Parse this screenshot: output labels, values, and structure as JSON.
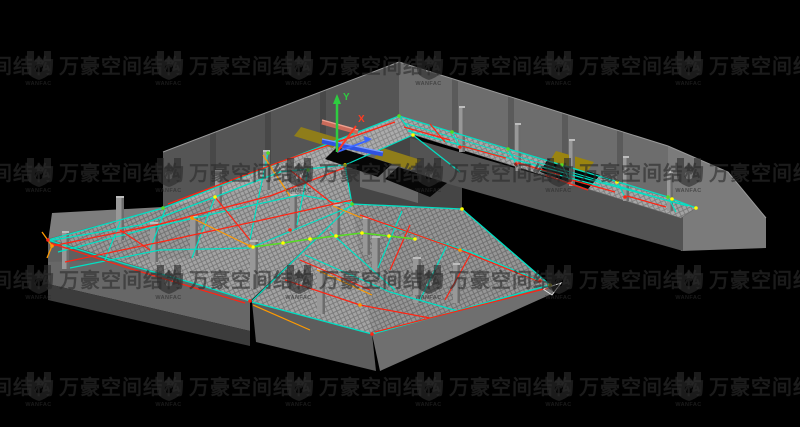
{
  "watermark": {
    "text": "万豪空间结构",
    "logo_text": "WANFAC",
    "color": "rgba(44,44,44,0.62)",
    "grid": {
      "x0": -105,
      "y0": -57,
      "step_x": 130,
      "step_y": 107,
      "cols": 7,
      "rows": 5
    }
  },
  "viewport": {
    "background": "#000000",
    "width": 800,
    "height": 427
  },
  "axis": {
    "y_label": "Y",
    "x_label": "X",
    "y_color": "#2ecc40",
    "x_color": "#ff3b22",
    "z_color": "#3a66ff",
    "origin": [
      337,
      152
    ],
    "y_end": [
      337,
      100
    ],
    "x_end": [
      356,
      126
    ],
    "z_end": [
      369,
      140
    ]
  },
  "palette": {
    "cyan": "#00e0c4",
    "red": "#ff2413",
    "orange": "#ff9a00",
    "green": "#55dd22",
    "yellow": "#ffff00",
    "white": "#e0e0e0",
    "gray": "#9a9a9a",
    "mesh": "#a3a3a3",
    "wall": "#6d6d6d",
    "slab": "#5d5d5d",
    "stair": "#8f7d1a",
    "beam_blue": "#2f52e0",
    "beam_salmon": "#c96a5a"
  },
  "model": {
    "base_polygons": [
      {
        "name": "left-back-wall",
        "points": "163,152 399,62 399,116 163,208",
        "fill": "#555555"
      },
      {
        "name": "wall-pilaster",
        "points": "210,134 216,132 216,184 210,186",
        "fill": "#484848"
      },
      {
        "name": "wall-pilaster",
        "points": "265,113 271,111 271,163 265,165",
        "fill": "#484848"
      },
      {
        "name": "wall-pilaster",
        "points": "320,92 326,90 326,142 320,144",
        "fill": "#484848"
      },
      {
        "name": "right-back-wall",
        "points": "399,62 668,146 668,207 399,116",
        "fill": "#6d6d6d"
      },
      {
        "name": "wall-pilaster",
        "points": "452,79 458,81 458,134 452,132",
        "fill": "#5a5a5a"
      },
      {
        "name": "wall-pilaster",
        "points": "508,96 514,98 514,151 508,149",
        "fill": "#5a5a5a"
      },
      {
        "name": "wall-pilaster",
        "points": "562,113 568,115 568,168 562,166",
        "fill": "#5a5a5a"
      },
      {
        "name": "wall-pilaster",
        "points": "617,130 623,132 623,185 617,183",
        "fill": "#5a5a5a"
      },
      {
        "name": "right-end-cap",
        "points": "668,146 728,172 766,218 766,248 681,251 668,207",
        "fill": "#7b7b7b"
      },
      {
        "name": "bay-floor",
        "points": "345,165 413,135 462,173 462,209 352,204",
        "fill": "#454545"
      },
      {
        "name": "inner-corner-wall",
        "points": "360,147 418,163 418,203 360,187",
        "fill": "#696969"
      },
      {
        "name": "right-front-slab",
        "points": "410,138 683,216 683,251 410,173",
        "fill": "#535353"
      },
      {
        "name": "left-end-cap",
        "points": "52,213 163,207 163,214 48,242",
        "fill": "#7d7d7d"
      },
      {
        "name": "left-front-slab",
        "points": "48,238 250,301 250,331 48,284",
        "fill": "#676767"
      },
      {
        "name": "left-front-slab-lower",
        "points": "48,284 250,331 250,346 48,300",
        "fill": "#3c3c3c"
      },
      {
        "name": "bottom-front-slab",
        "points": "252,302 372,334 376,371 256,342",
        "fill": "#5d5d5d"
      },
      {
        "name": "bottom-se-slab",
        "points": "372,334 550,285 554,293 380,371",
        "fill": "#6f6f6f"
      }
    ],
    "mesh_polygons": [
      {
        "name": "left-wing-mesh",
        "points": "163,208 399,116 413,135 345,165 352,204 250,301 48,239"
      },
      {
        "name": "bottom-wing-mesh",
        "points": "352,204 462,209 550,285 372,334 252,302"
      },
      {
        "name": "right-wing-mesh",
        "points": "399,116 672,199 696,208 681,218 408,133"
      }
    ],
    "mesh_shades": [
      {
        "points": "163,208 399,116 413,135 345,165",
        "fill": "rgba(255,255,255,0.10)"
      },
      {
        "points": "352,204 462,209 550,285 372,334",
        "fill": "rgba(0,0,0,0.08)"
      },
      {
        "points": "399,116 672,199 681,218 408,133",
        "fill": "rgba(255,255,255,0.06)"
      },
      {
        "points": "48,239 163,208 215,197 192,258 48,262",
        "fill": "rgba(0,0,0,0.06)"
      }
    ],
    "overlay_polygons": [
      {
        "name": "floor-opening",
        "points": "337,147 392,164 378,177 325,159",
        "fill": "#060606"
      },
      {
        "name": "floor-opening",
        "points": "398,167 447,183 430,197 385,179",
        "fill": "#060606"
      },
      {
        "name": "floor-opening",
        "points": "548,159 600,175 588,189 540,172",
        "fill": "#060606"
      },
      {
        "name": "stair-panel",
        "points": "301,127 341,139 333,148 294,136",
        "fill": "#8f7d1a"
      },
      {
        "name": "stair-panel",
        "points": "383,148 421,160 411,170 374,158",
        "fill": "#8f7d1a"
      },
      {
        "name": "stair-panel",
        "points": "556,151 594,162 586,173 549,162",
        "fill": "#9a8410"
      }
    ],
    "columns": [
      {
        "x": 62,
        "y": 231,
        "h": 38,
        "w": 7
      },
      {
        "x": 116,
        "y": 196,
        "h": 44,
        "w": 8
      },
      {
        "x": 150,
        "y": 222,
        "h": 40,
        "w": 8
      },
      {
        "x": 190,
        "y": 216,
        "h": 40,
        "w": 8
      },
      {
        "x": 215,
        "y": 170,
        "h": 36,
        "w": 7
      },
      {
        "x": 263,
        "y": 150,
        "h": 40,
        "w": 7
      },
      {
        "x": 290,
        "y": 194,
        "h": 36,
        "w": 7
      },
      {
        "x": 333,
        "y": 204,
        "h": 36,
        "w": 7
      },
      {
        "x": 363,
        "y": 217,
        "h": 38,
        "w": 7
      },
      {
        "x": 250,
        "y": 240,
        "h": 48,
        "w": 8
      },
      {
        "x": 317,
        "y": 268,
        "h": 46,
        "w": 8
      },
      {
        "x": 372,
        "y": 236,
        "h": 42,
        "w": 8
      },
      {
        "x": 413,
        "y": 257,
        "h": 46,
        "w": 8
      },
      {
        "x": 453,
        "y": 263,
        "h": 40,
        "w": 7
      },
      {
        "x": 459,
        "y": 106,
        "h": 46,
        "w": 6
      },
      {
        "x": 515,
        "y": 123,
        "h": 48,
        "w": 6
      },
      {
        "x": 569,
        "y": 139,
        "h": 47,
        "w": 6
      },
      {
        "x": 623,
        "y": 156,
        "h": 45,
        "w": 6
      },
      {
        "x": 667,
        "y": 171,
        "h": 40,
        "w": 6
      }
    ],
    "lines": [
      {
        "c": "gray",
        "w": 1,
        "p": "163,152 399,62"
      },
      {
        "c": "gray",
        "w": 1,
        "p": "399,62 668,146"
      },
      {
        "c": "gray",
        "w": 1,
        "p": "668,146 728,172 766,218"
      },
      {
        "c": "cyan",
        "w": 1.3,
        "p": "399,116 668,197"
      },
      {
        "c": "cyan",
        "w": 1.3,
        "p": "408,131 688,206"
      },
      {
        "c": "cyan",
        "w": 1,
        "p": "404,123 676,203"
      },
      {
        "c": "cyan",
        "w": 1.3,
        "p": "672,199 696,208"
      },
      {
        "c": "cyan",
        "w": 1.2,
        "p": "452,132 460,147"
      },
      {
        "c": "cyan",
        "w": 1.2,
        "p": "508,149 516,164"
      },
      {
        "c": "cyan",
        "w": 1.2,
        "p": "562,165 570,181"
      },
      {
        "c": "cyan",
        "w": 1.2,
        "p": "617,182 625,197"
      },
      {
        "c": "cyan",
        "w": 1.2,
        "p": "668,197 676,212"
      },
      {
        "c": "cyan",
        "w": 1.3,
        "p": "163,208 399,116"
      },
      {
        "c": "cyan",
        "w": 1.3,
        "p": "48,240 163,208"
      },
      {
        "c": "cyan",
        "w": 1.3,
        "p": "48,241 140,225 215,197 280,172 345,165"
      },
      {
        "c": "cyan",
        "w": 1.3,
        "p": "58,252 150,228 230,210 300,195 352,204"
      },
      {
        "c": "cyan",
        "w": 1.2,
        "p": "70,268 160,250 250,248 352,206"
      },
      {
        "c": "cyan",
        "w": 1.3,
        "p": "48,240 125,264 200,285 250,301"
      },
      {
        "c": "cyan",
        "w": 1.2,
        "p": "252,301 352,204"
      },
      {
        "c": "cyan",
        "w": 1.2,
        "p": "215,197 192,258"
      },
      {
        "c": "cyan",
        "w": 1.2,
        "p": "268,153 258,200 250,240"
      },
      {
        "c": "cyan",
        "w": 1.2,
        "p": "308,170 297,225"
      },
      {
        "c": "cyan",
        "w": 1.2,
        "p": "165,210 150,250"
      },
      {
        "c": "cyan",
        "w": 1.2,
        "p": "120,222 105,260"
      },
      {
        "c": "cyan",
        "w": 1.2,
        "p": "345,165 352,204"
      },
      {
        "c": "cyan",
        "w": 1.2,
        "p": "399,116 413,134"
      },
      {
        "c": "cyan",
        "w": 1.2,
        "p": "345,165 413,135"
      },
      {
        "c": "cyan",
        "w": 1.2,
        "p": "413,135 460,172"
      },
      {
        "c": "cyan",
        "w": 1.3,
        "p": "352,204 462,209"
      },
      {
        "c": "cyan",
        "w": 1.3,
        "p": "462,209 550,285"
      },
      {
        "c": "cyan",
        "w": 1.3,
        "p": "550,285 372,334"
      },
      {
        "c": "cyan",
        "w": 1.3,
        "p": "252,302 372,334"
      },
      {
        "c": "cyan",
        "w": 1.2,
        "p": "385,225 470,252 540,281"
      },
      {
        "c": "cyan",
        "w": 1.2,
        "p": "305,255 390,292 458,311"
      },
      {
        "c": "cyan",
        "w": 1.2,
        "p": "402,211 378,268"
      },
      {
        "c": "cyan",
        "w": 1.2,
        "p": "448,243 420,300"
      },
      {
        "c": "cyan",
        "w": 1.2,
        "p": "330,232 395,290"
      },
      {
        "c": "cyan",
        "w": 1.2,
        "p": "540,170 600,186"
      },
      {
        "c": "red",
        "w": 1.2,
        "p": "404,127 450,140"
      },
      {
        "c": "red",
        "w": 1.2,
        "p": "462,146 506,158"
      },
      {
        "c": "red",
        "w": 1.2,
        "p": "518,163 560,175"
      },
      {
        "c": "red",
        "w": 1.2,
        "p": "572,180 615,192"
      },
      {
        "c": "red",
        "w": 1.2,
        "p": "627,196 666,207"
      },
      {
        "c": "red",
        "w": 1.2,
        "p": "430,124 445,142"
      },
      {
        "c": "red",
        "w": 1.2,
        "p": "545,175 588,190"
      },
      {
        "c": "red",
        "w": 1.3,
        "p": "168,204 280,162 395,122"
      },
      {
        "c": "red",
        "w": 1.3,
        "p": "52,246 160,224 270,196 344,168"
      },
      {
        "c": "red",
        "w": 1.2,
        "p": "65,262 170,240 262,220 352,200"
      },
      {
        "c": "red",
        "w": 1.2,
        "p": "215,197 250,240"
      },
      {
        "c": "red",
        "w": 1.2,
        "p": "290,170 333,204"
      },
      {
        "c": "red",
        "w": 1.2,
        "p": "120,230 150,250"
      },
      {
        "c": "red",
        "w": 1.2,
        "p": "50,243 125,267 245,303"
      },
      {
        "c": "red",
        "w": 1.2,
        "p": "360,215 460,250 540,282"
      },
      {
        "c": "red",
        "w": 1.2,
        "p": "285,280 360,305 430,318"
      },
      {
        "c": "red",
        "w": 1.2,
        "p": "300,260 370,290"
      },
      {
        "c": "red",
        "w": 1.2,
        "p": "410,225 390,270"
      },
      {
        "c": "red",
        "w": 1.2,
        "p": "470,255 445,300"
      },
      {
        "c": "red",
        "w": 1.2,
        "p": "548,288 375,332"
      },
      {
        "c": "orange",
        "w": 1.3,
        "p": "42,232 52,246 47,258"
      },
      {
        "c": "orange",
        "w": 1.2,
        "p": "192,218 250,246"
      },
      {
        "c": "orange",
        "w": 1.2,
        "p": "263,155 290,196"
      },
      {
        "c": "orange",
        "w": 1.2,
        "p": "253,305 310,330"
      },
      {
        "c": "orange",
        "w": 1.2,
        "p": "317,270 372,295"
      },
      {
        "c": "orange",
        "w": 1.2,
        "p": "333,206 362,218"
      },
      {
        "c": "green",
        "w": 1.5,
        "p": "253,247 283,243 310,239 336,236 362,233 389,236 415,239"
      },
      {
        "c": "#2f52e0",
        "w": 5,
        "p": "322,141 383,154"
      },
      {
        "c": "#7f9cff",
        "w": 1.4,
        "p": "322,139 383,152"
      },
      {
        "c": "#c96a5a",
        "w": 5,
        "p": "322,122 358,132"
      },
      {
        "c": "#efa08f",
        "w": 1.4,
        "p": "322,120 358,130"
      },
      {
        "c": "white",
        "w": 1,
        "p": "543,289 561,283 552,295 543,289"
      }
    ],
    "dots": [
      {
        "x": 253,
        "y": 247,
        "c": "yellow"
      },
      {
        "x": 283,
        "y": 243,
        "c": "yellow"
      },
      {
        "x": 310,
        "y": 239,
        "c": "yellow"
      },
      {
        "x": 336,
        "y": 236,
        "c": "yellow"
      },
      {
        "x": 362,
        "y": 233,
        "c": "yellow"
      },
      {
        "x": 389,
        "y": 236,
        "c": "yellow"
      },
      {
        "x": 415,
        "y": 239,
        "c": "yellow"
      },
      {
        "x": 345,
        "y": 165,
        "c": "yellow"
      },
      {
        "x": 413,
        "y": 135,
        "c": "yellow"
      },
      {
        "x": 462,
        "y": 209,
        "c": "yellow"
      },
      {
        "x": 672,
        "y": 199,
        "c": "yellow"
      },
      {
        "x": 696,
        "y": 208,
        "c": "yellow"
      },
      {
        "x": 550,
        "y": 285,
        "c": "yellow"
      },
      {
        "x": 215,
        "y": 197,
        "c": "yellow"
      },
      {
        "x": 617,
        "y": 182,
        "c": "yellow"
      },
      {
        "x": 452,
        "y": 132,
        "c": "green"
      },
      {
        "x": 508,
        "y": 149,
        "c": "green"
      },
      {
        "x": 562,
        "y": 165,
        "c": "green"
      },
      {
        "x": 668,
        "y": 197,
        "c": "green"
      },
      {
        "x": 268,
        "y": 153,
        "c": "green"
      },
      {
        "x": 308,
        "y": 170,
        "c": "green"
      },
      {
        "x": 163,
        "y": 208,
        "c": "green"
      },
      {
        "x": 399,
        "y": 116,
        "c": "green"
      },
      {
        "x": 352,
        "y": 204,
        "c": "green"
      },
      {
        "x": 460,
        "y": 147,
        "c": "red"
      },
      {
        "x": 516,
        "y": 164,
        "c": "red"
      },
      {
        "x": 570,
        "y": 181,
        "c": "red"
      },
      {
        "x": 625,
        "y": 197,
        "c": "red"
      },
      {
        "x": 250,
        "y": 301,
        "c": "red"
      },
      {
        "x": 372,
        "y": 334,
        "c": "red"
      },
      {
        "x": 48,
        "y": 240,
        "c": "red"
      },
      {
        "x": 290,
        "y": 230,
        "c": "red"
      },
      {
        "x": 540,
        "y": 281,
        "c": "red"
      },
      {
        "x": 52,
        "y": 246,
        "c": "orange"
      },
      {
        "x": 192,
        "y": 218,
        "c": "orange"
      },
      {
        "x": 250,
        "y": 246,
        "c": "orange"
      },
      {
        "x": 460,
        "y": 250,
        "c": "orange"
      },
      {
        "x": 360,
        "y": 305,
        "c": "orange"
      }
    ]
  }
}
